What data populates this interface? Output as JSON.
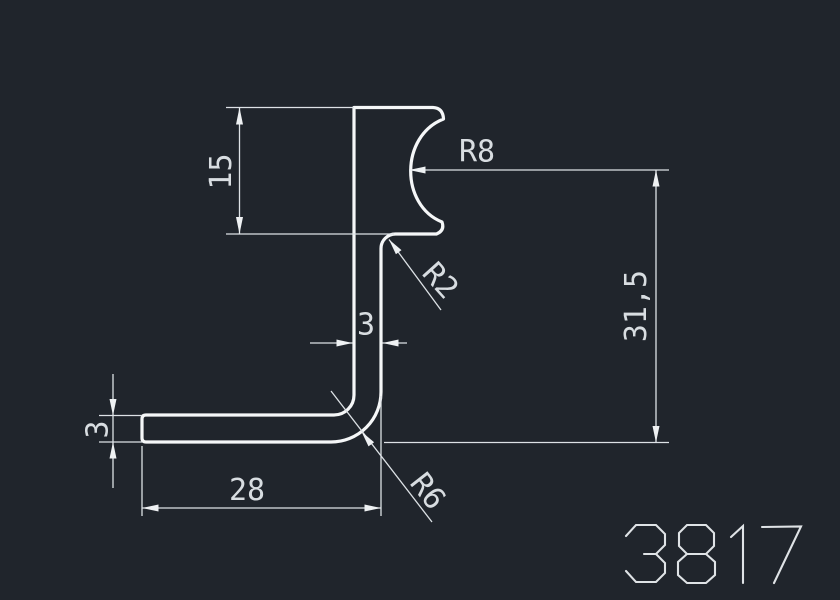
{
  "drawing": {
    "part_number": "3817",
    "dimensions": {
      "notch_height": "15",
      "notch_radius": "R8",
      "step_radius": "R2",
      "stem_width": "3",
      "total_height": "31,5",
      "leg_thickness": "3",
      "leg_length": "28",
      "corner_radius": "R6"
    },
    "colors": {
      "background": "#20252c",
      "profile_line": "#f5f7f8",
      "dimension_line": "#dde2e6",
      "text": "#d8dde1"
    }
  }
}
